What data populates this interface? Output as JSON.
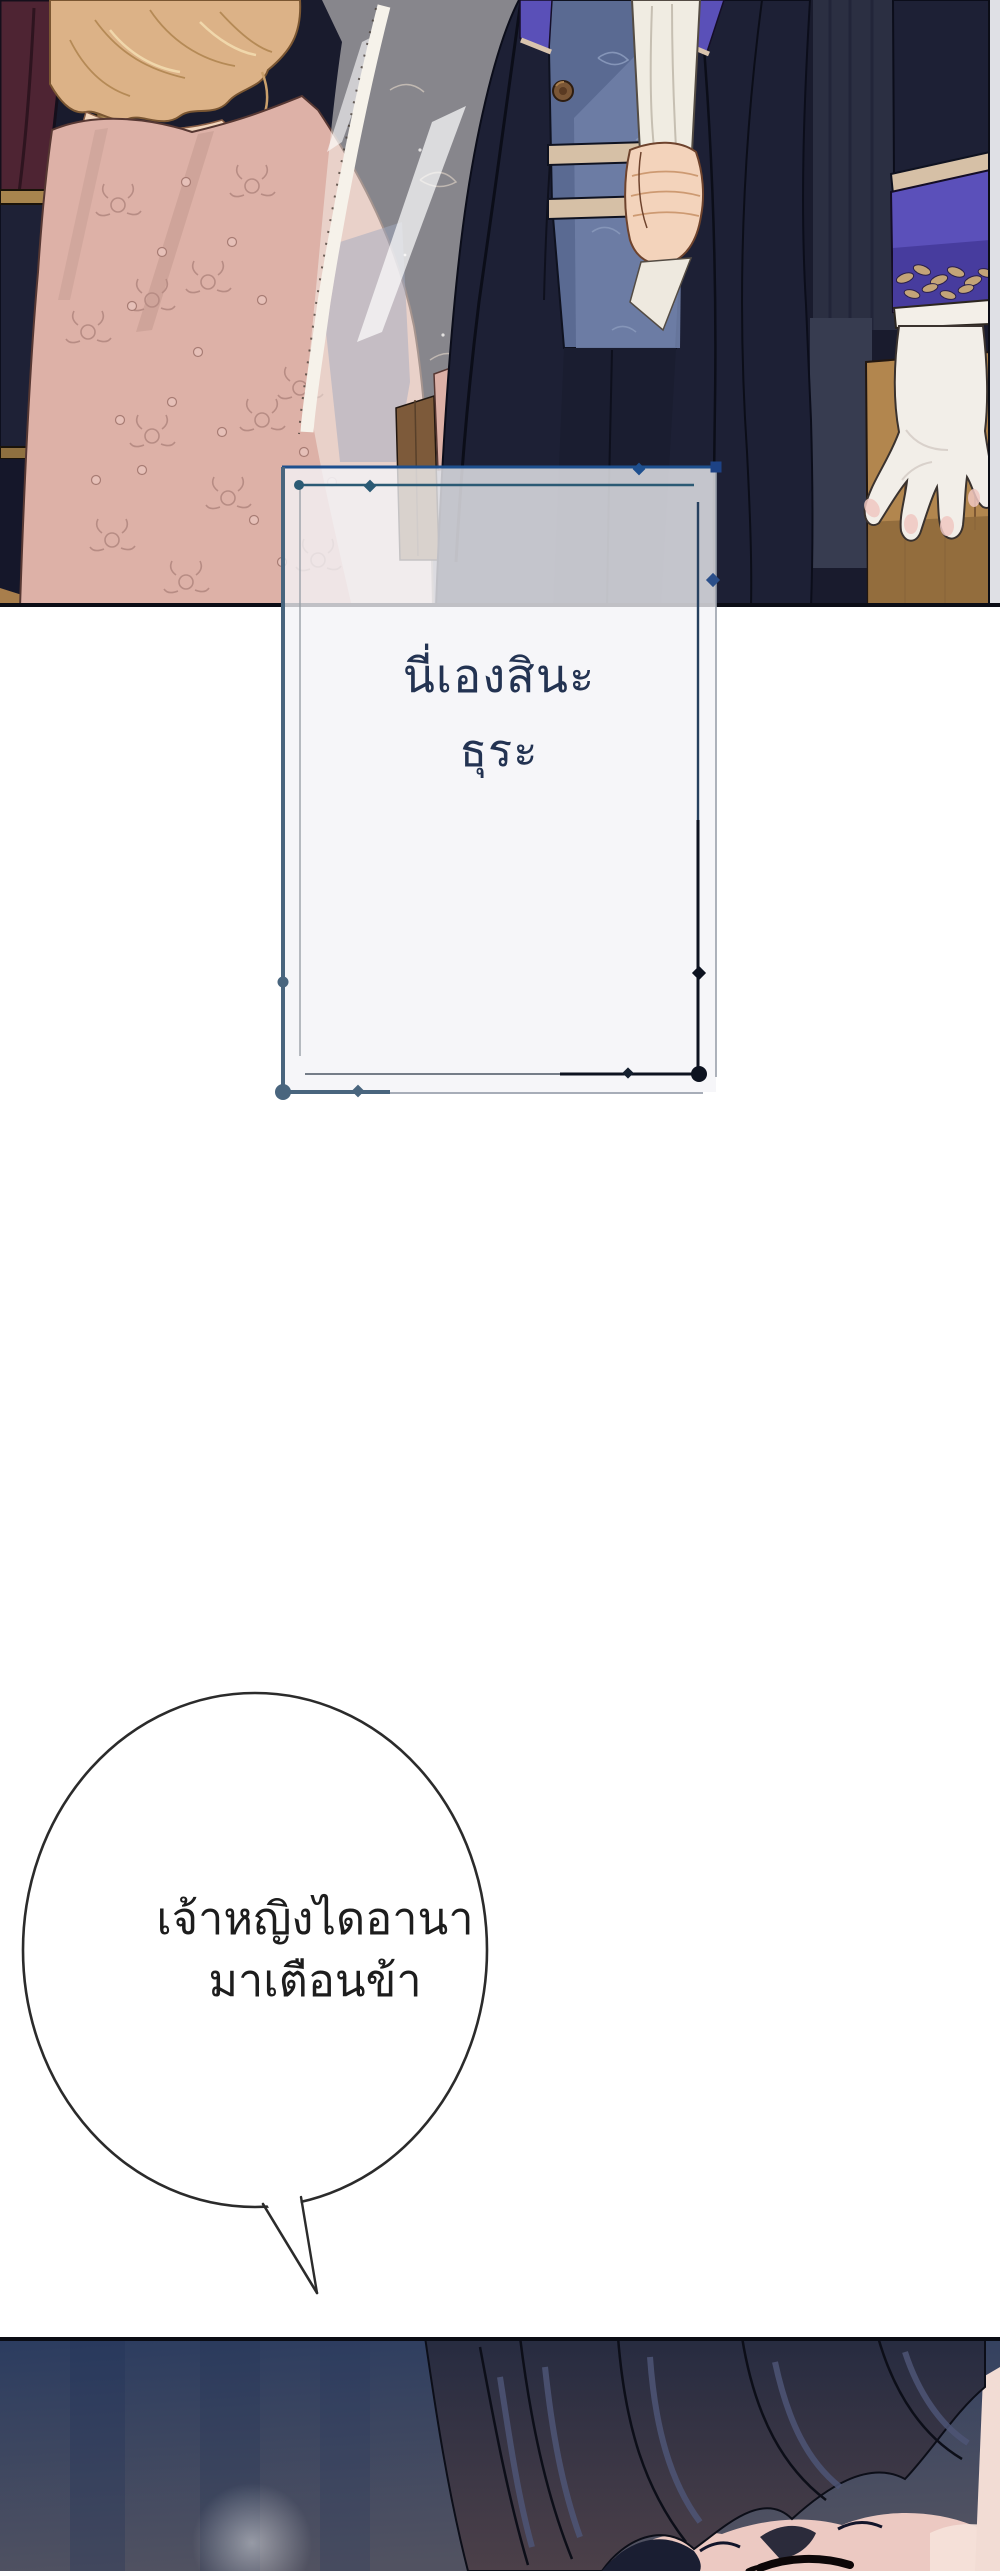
{
  "page": {
    "width": 1000,
    "height": 2571,
    "background_color": "#ffffff"
  },
  "top_panel": {
    "type": "illustration",
    "alt": "Blonde woman in a pink lace gown draped with a sheer fringed shawl stands beside a man in a dark navy coat with an ornate blue waistcoat, purple embroidered cuff and white gloved hand; dark interior with gold pole and wooden floor",
    "palette": {
      "background_navy": "#191b2d",
      "maroon_drape": "#4e2433",
      "gold_pole": "#c2a26a",
      "hair_blonde": "#dcb287",
      "dress_pink": "#ddb1a7",
      "lace_rose": "#b68b83",
      "shawl_white": "#f6f2ea",
      "coat_navy": "#1d2035",
      "vest_blue": "#5a6a92",
      "vest_piping_tan": "#d6c0a6",
      "sleeve_purple": "#5b50ba",
      "embroidery_gold": "#c3a478",
      "glove_white": "#f2eee8",
      "skin": "#f3d3bb",
      "wood_floor": "#b2864e"
    }
  },
  "narration_box": {
    "lines": [
      "นี่เองสินะ",
      "ธุระ"
    ],
    "text_color": "#233352",
    "fill_color": "rgba(243,244,247,0.78)",
    "frame_colors": {
      "top_blue": "#1d4f8e",
      "left_slate": "#49657e",
      "inner_teal": "#2b5a74",
      "bottom_right_black": "#0d1320"
    }
  },
  "speech_bubble": {
    "lines": [
      "เจ้าหญิงไดอานา",
      "มาเตือนข้า"
    ],
    "text_color": "#1d1d1d",
    "outline_color": "#2b2b2b",
    "fill_color": "#ffffff"
  },
  "bottom_panel": {
    "type": "illustration",
    "alt": "Close-up of the top of a dark-haired head with swept bangs against a blue-gray gradient; forehead and a closed eye line appear at the bottom edge",
    "palette": {
      "background_blue": "#2b3c60",
      "hair_dark": "#242840",
      "hair_highlight": "#4e5576",
      "skin": "#ecc9c2"
    }
  }
}
